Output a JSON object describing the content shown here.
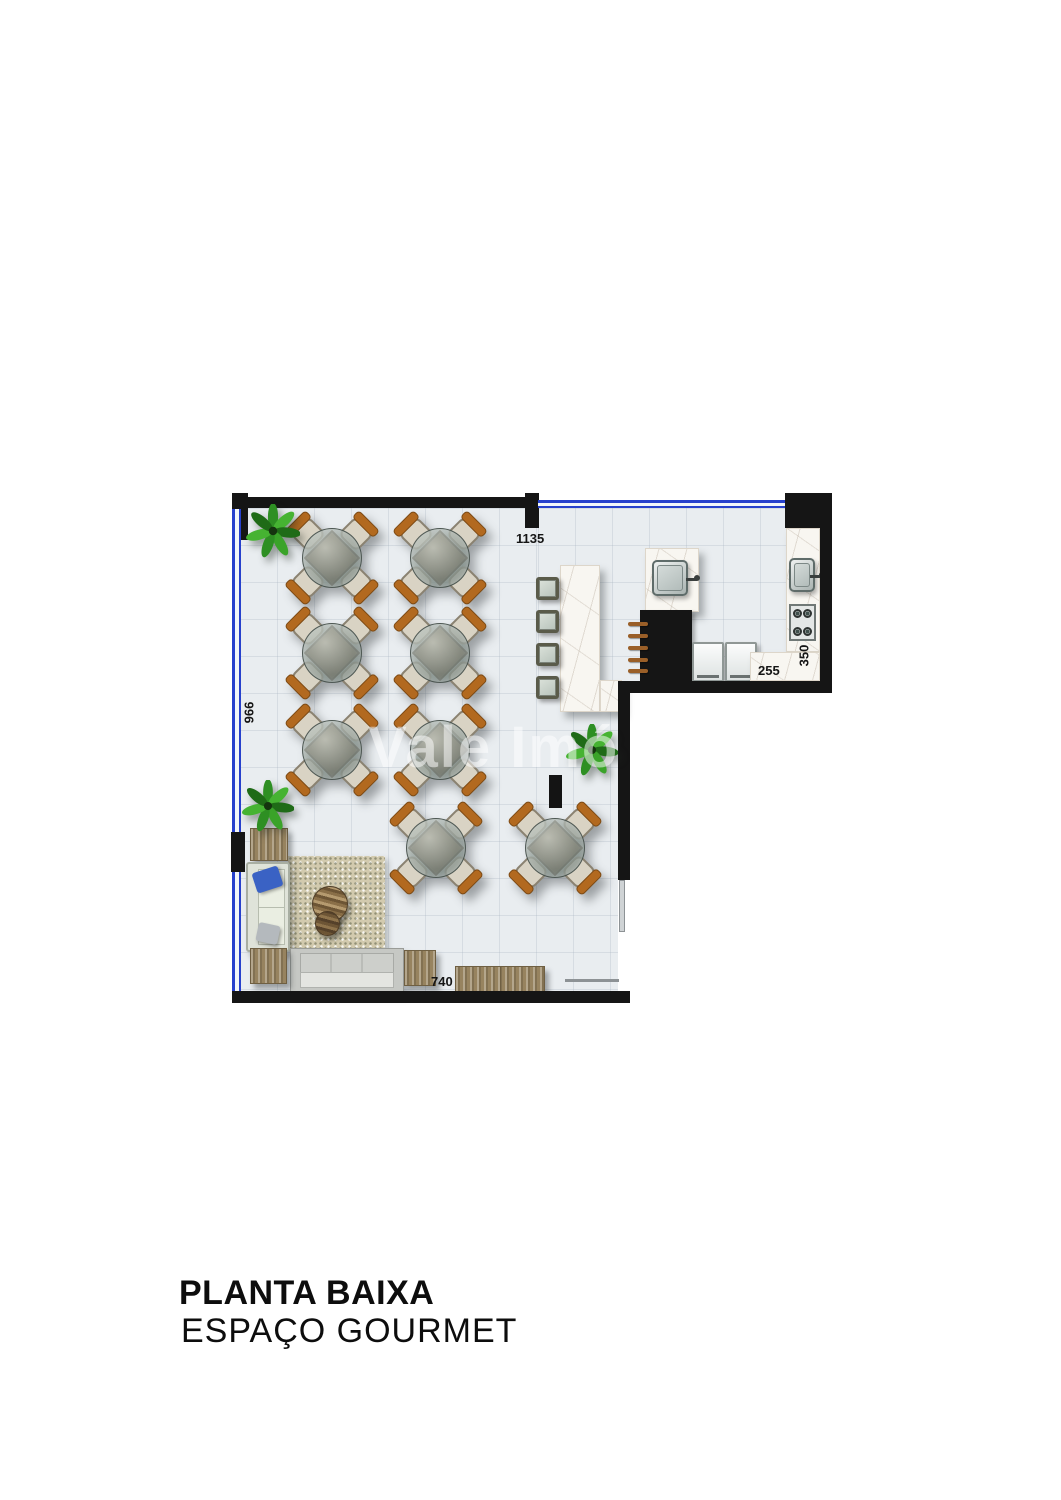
{
  "title": {
    "line1": "PLANTA BAIXA",
    "line2": "ESPAÇO GOURMET"
  },
  "watermark": "Vale Imó",
  "dimensions": {
    "top_width": "1135",
    "left_height": "966",
    "kitchen_counter_depth": "350",
    "kitchen_counter_width": "255",
    "bottom_width": "740"
  },
  "colors": {
    "wall": "#151515",
    "window_glass_blue": "#2741cc",
    "floor_tile": "#e9edf0",
    "marble_counter": "#f8f6f1",
    "wood": "#97835f",
    "brick": "#d8c3a2",
    "plant_green": "#2e8f23",
    "chair_accent": "#b2691f",
    "sofa_pillow_blue": "#3a62c4"
  },
  "furniture_inventory": {
    "dining_tables": 8,
    "chairs_per_table": 4,
    "bar_stools": 4,
    "sofas": 2,
    "side_tables": 3,
    "sideboards": 1,
    "coffee_tables": 1,
    "rugs": 1,
    "plants": 3,
    "refrigerators": 2,
    "sinks": 2,
    "stoves": 1,
    "barbecue_grills": 1,
    "columns": 2
  }
}
